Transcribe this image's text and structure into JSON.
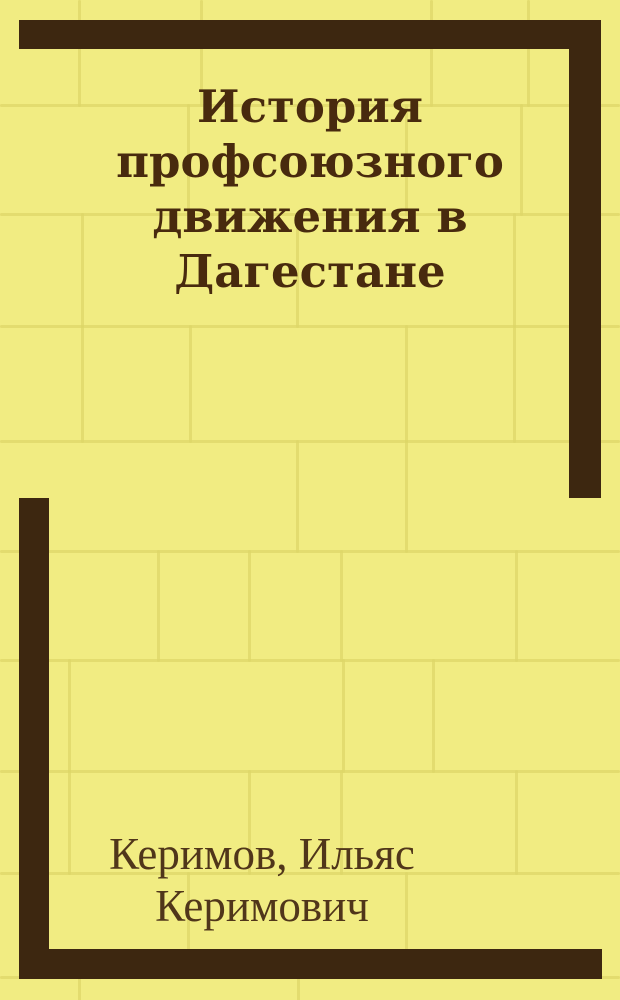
{
  "cover": {
    "kind_label": "book-cover-scan"
  },
  "title": {
    "text": "История профсоюзного движения в Дагестане",
    "lines": [
      "История",
      "профсоюзного",
      "движения в",
      "Дагестане"
    ]
  },
  "author": {
    "text": "Керимов, Ильяс Керимович",
    "lines": [
      "Керимов, Ильяс",
      "Керимович"
    ]
  },
  "colors": {
    "bg": "#f1ec82",
    "mortar": "#ded768",
    "frame": "#3d2710",
    "title": "#482a0e",
    "author": "#50361a"
  }
}
